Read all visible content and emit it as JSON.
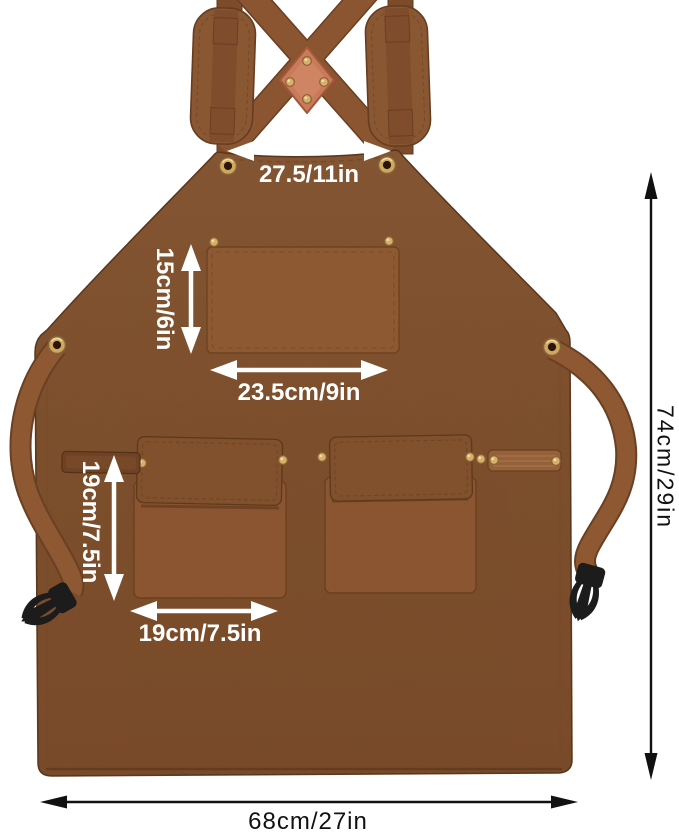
{
  "image": {
    "kind": "product dimension diagram",
    "subject": "canvas work apron with cross-back straps"
  },
  "measurements": {
    "top_width": "27.5/11in",
    "chest_pocket_height": "15cm/6in",
    "chest_pocket_width": "23.5cm/9in",
    "waist_pocket_height": "19cm/7.5in",
    "waist_pocket_width": "19cm/7.5in",
    "apron_length": "74cm/29in",
    "bottom_width": "68cm/27in"
  },
  "colors": {
    "background": "#ffffff",
    "apron_fabric": "#8e5a33",
    "strap_webbing": "#8a5530",
    "pocket_flap": "#7f4e2b",
    "leather_patch": "#c97a5b",
    "grommet_brass": "#cfa75f",
    "rivet_brass": "#d7b06c",
    "buckle_black": "#1c1c1c",
    "annotation_light": "#ffffff",
    "annotation_dark": "#111111"
  }
}
